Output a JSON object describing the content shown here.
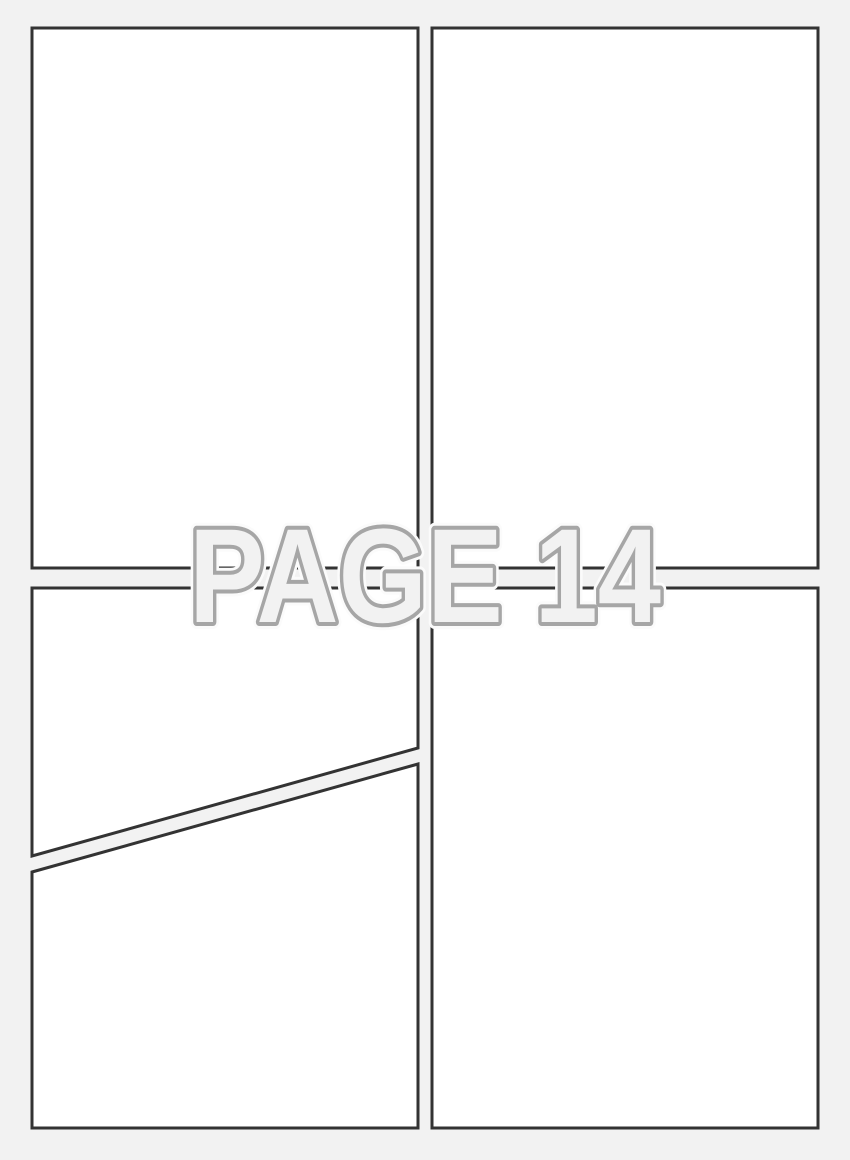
{
  "page": {
    "kind": "comic-page-template",
    "watermark": {
      "text": "PAGE 14"
    },
    "colors": {
      "background": "#f2f2f2",
      "panel_fill": "#ffffff",
      "panel_border": "#333333",
      "watermark_fill": "#f2f2f2",
      "watermark_outline": "#a6a6a6",
      "watermark_halo": "#fbfbfb"
    },
    "panels": [
      {
        "name": "panel-top-left",
        "shape": "rect"
      },
      {
        "name": "panel-top-right",
        "shape": "rect"
      },
      {
        "name": "panel-bottom-left-upper",
        "shape": "diagonal-polygon"
      },
      {
        "name": "panel-bottom-left-lower",
        "shape": "diagonal-polygon"
      },
      {
        "name": "panel-bottom-right",
        "shape": "rect"
      }
    ]
  }
}
